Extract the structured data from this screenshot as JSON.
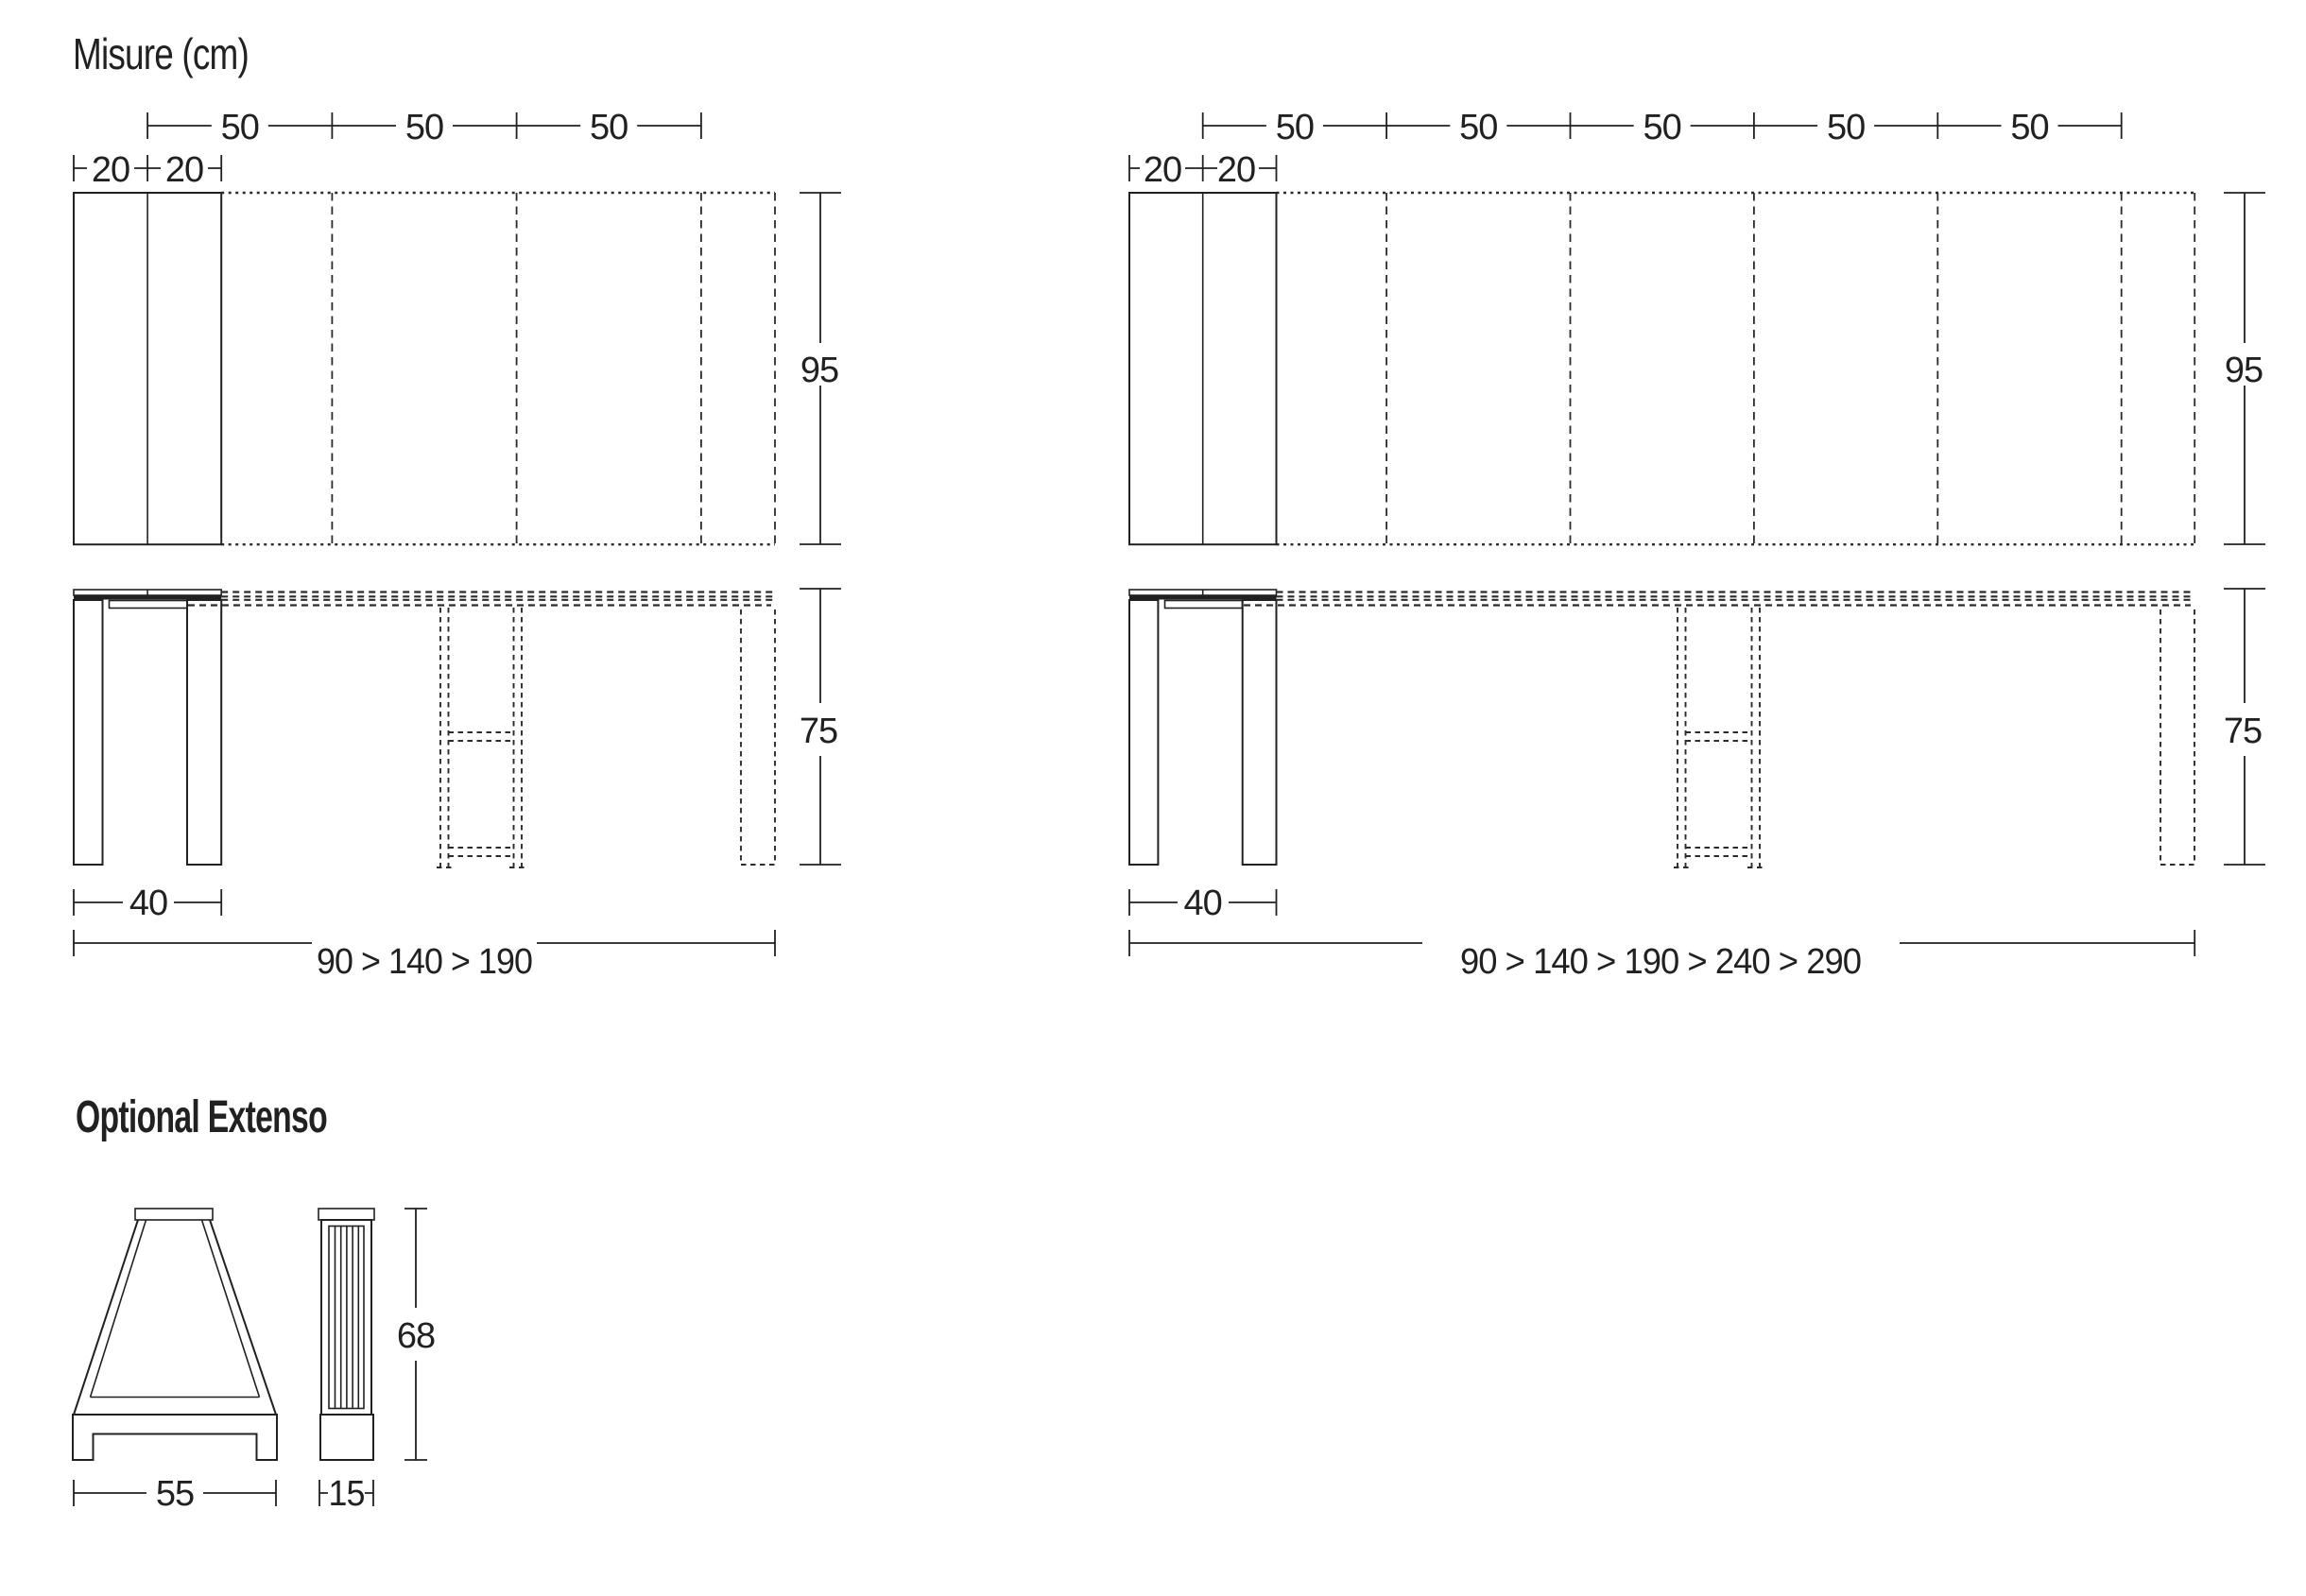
{
  "page": {
    "title": "Misure (cm)"
  },
  "left_table": {
    "leaf_dims": [
      "50",
      "50",
      "50"
    ],
    "panel_dims": [
      "20",
      "20"
    ],
    "depth_cm": "95",
    "height_cm": "75",
    "base_width_cm": "40",
    "length_range": "90 > 140 > 190"
  },
  "right_table": {
    "leaf_dims": [
      "50",
      "50",
      "50",
      "50",
      "50"
    ],
    "panel_dims": [
      "20",
      "20"
    ],
    "depth_cm": "95",
    "height_cm": "75",
    "base_width_cm": "40",
    "length_range": "90 > 140 > 190 > 240 > 290"
  },
  "extenso": {
    "title": "Optional Extenso",
    "width_cm": "55",
    "thickness_cm": "15",
    "height_cm": "68"
  },
  "colors": {
    "line": "#212121",
    "bg": "#ffffff"
  }
}
